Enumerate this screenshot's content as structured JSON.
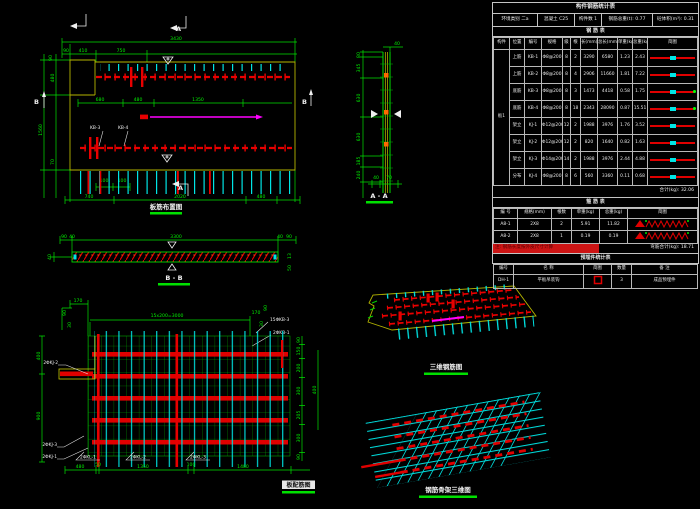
{
  "panel": {
    "main_title": "构件钢筋统计表",
    "info": [
      "环境类别 二a",
      "混凝土 C25",
      "构件数 1",
      "钢筋总重(t): 0.77",
      "砼体积(m³): 0.31"
    ],
    "rebar": {
      "title": "钢 筋 表",
      "headers": [
        "构件",
        "位置",
        "编号",
        "规格",
        "级",
        "根",
        "长(mm)",
        "总长(mm)",
        "单重(kg)",
        "总重(kg)",
        "简图"
      ],
      "component": "板1",
      "rows": [
        {
          "pos": "上筋",
          "no": "KB-1",
          "spec": "Φ8@200",
          "lv": "8",
          "n": "2",
          "len": "3290",
          "tlen": "6580",
          "uw": "1.23",
          "tw": "2.43"
        },
        {
          "pos": "上筋",
          "no": "KB-2",
          "spec": "Φ8@200",
          "lv": "8",
          "n": "4",
          "len": "2906",
          "tlen": "11660",
          "uw": "1.81",
          "tw": "7.22"
        },
        {
          "pos": "底筋",
          "no": "KB-3",
          "spec": "Φ8@200",
          "lv": "8",
          "n": "3",
          "len": "1473",
          "tlen": "4418",
          "uw": "0.58",
          "tw": "1.75"
        },
        {
          "pos": "底筋",
          "no": "KB-4",
          "spec": "Φ8@200",
          "lv": "8",
          "n": "18",
          "len": "2343",
          "tlen": "28090",
          "uw": "0.87",
          "tw": "15.51"
        },
        {
          "pos": "架立",
          "no": "KJ-1",
          "spec": "Φ12@200",
          "lv": "12",
          "n": "2",
          "len": "1988",
          "tlen": "3976",
          "uw": "1.76",
          "tw": "3.52"
        },
        {
          "pos": "架立",
          "no": "KJ-2",
          "spec": "Φ12@200",
          "lv": "12",
          "n": "2",
          "len": "820",
          "tlen": "1640",
          "uw": "0.82",
          "tw": "1.63"
        },
        {
          "pos": "架立",
          "no": "KJ-3",
          "spec": "Φ14@200",
          "lv": "14",
          "n": "2",
          "len": "1988",
          "tlen": "3976",
          "uw": "2.44",
          "tw": "4.88"
        },
        {
          "pos": "分布",
          "no": "KJ-4",
          "spec": "Φ8@200",
          "lv": "8",
          "n": "6",
          "len": "560",
          "tlen": "3360",
          "uw": "0.11",
          "tw": "0.68"
        }
      ],
      "sum": "合计(kg): 32.06"
    },
    "hoop": {
      "title": "箍 筋 表",
      "headers": [
        "编 号",
        "规格(mm)",
        "根数",
        "单重(kg)",
        "总重(kg)",
        "简图"
      ],
      "rows": [
        {
          "no": "A8-1",
          "spec": "2X8",
          "n": "2",
          "uw": "5.91",
          "tw": "11.82"
        },
        {
          "no": "A8-2",
          "spec": "2X8",
          "n": "1",
          "uw": "0.19",
          "tw": "0.19"
        }
      ],
      "note": "注: 钢筋长度按外皮尺寸计算",
      "note_right": "弯筋合计(kg): 18.71"
    },
    "embed": {
      "title": "预埋件统计表",
      "headers": [
        "编号",
        "名 称",
        "简图",
        "数量",
        "备 注"
      ],
      "row": {
        "no": "DH-1",
        "name": "平板吊装钩",
        "n": "3",
        "remark": "成品预埋件"
      }
    }
  },
  "plan": {
    "title": "板筋布置图",
    "overall_top": "3430",
    "top": [
      "90",
      "410",
      "750"
    ],
    "left": [
      "90",
      "480",
      "1560",
      "70"
    ],
    "mid": [
      "680",
      "480",
      "1350"
    ],
    "inner": [
      "100",
      "100"
    ],
    "bottom": [
      "740",
      "2020",
      "480"
    ],
    "mark_a": "A",
    "mark_b": "B",
    "leaders": [
      "KB-3",
      "KB-4"
    ]
  },
  "bb": {
    "title": "B - B",
    "top": [
      "90",
      "40",
      "3300",
      "40",
      "90"
    ],
    "left": "40",
    "right": [
      "13",
      "50"
    ]
  },
  "aa": {
    "title": "A - A",
    "top": "40",
    "left": [
      "80",
      "345",
      "630",
      "630",
      "185",
      "240"
    ],
    "bottom": [
      "40",
      "70"
    ]
  },
  "grid": {
    "title": "板配筋图",
    "span": "15x200=3000",
    "tl": [
      "170",
      "90",
      "30"
    ],
    "tr": [
      "170",
      "90",
      "30"
    ],
    "left": [
      "400",
      "900"
    ],
    "right": [
      "90",
      "150",
      "200",
      "300",
      "205",
      "300",
      "90"
    ],
    "right2": [
      "400"
    ],
    "bottom": [
      "480",
      "50",
      "1350",
      "100",
      "1480"
    ],
    "lead_left": [
      "2ΦKJ-2",
      "2ΦKJ-3",
      "2ΦKJ-1"
    ],
    "lead_bottom": [
      "2ΦKL-1",
      "2ΦKL-2",
      "2ΦKL-3"
    ],
    "lead_right": [
      "15ΦKB-3",
      "2ΦKB-1"
    ]
  },
  "iso1": {
    "title": "三维钢筋图"
  },
  "iso2": {
    "title": "钢筋骨架三维图"
  }
}
